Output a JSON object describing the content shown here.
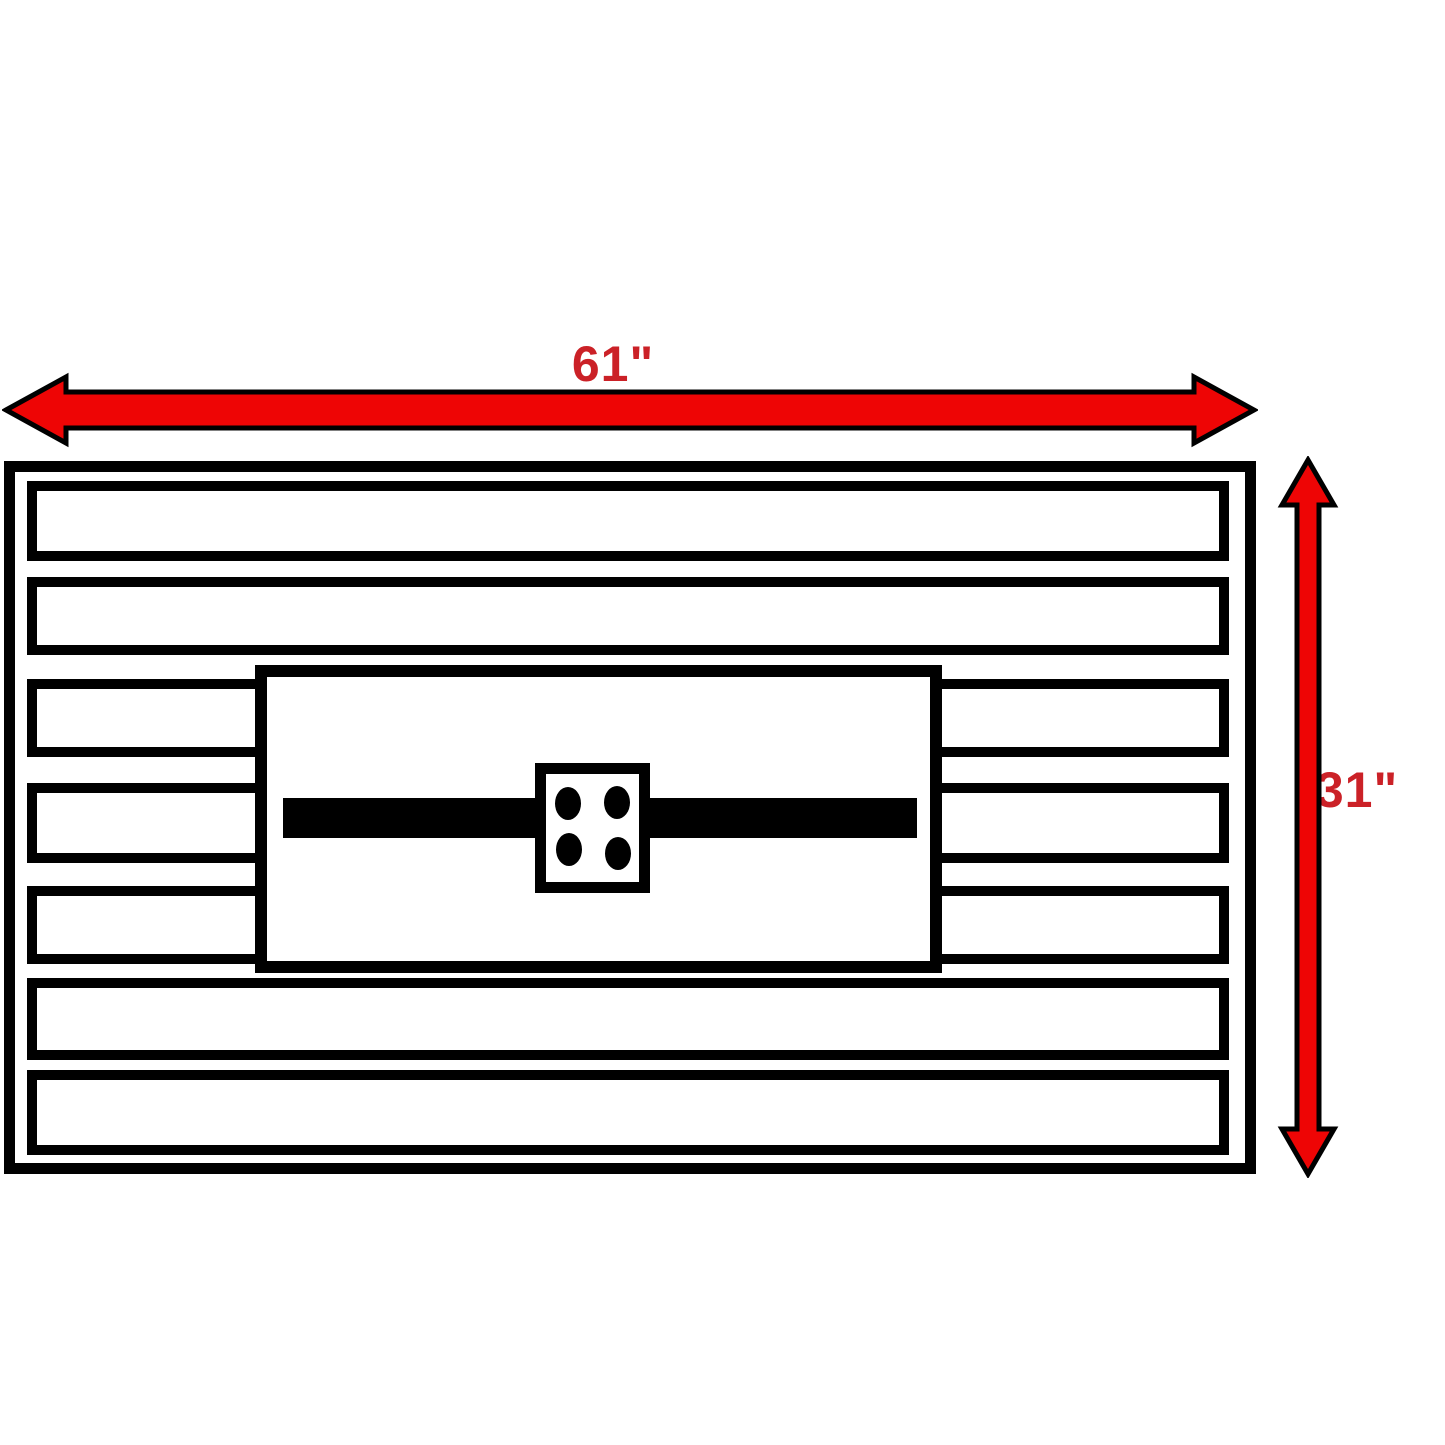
{
  "dimensions": {
    "width_label": "61\"",
    "height_label": "31\""
  },
  "diagram": {
    "type": "dimension-drawing",
    "view": "top-view",
    "slat_rows_total": 7,
    "full_width_slat_rows": 4,
    "split_slat_rows": 3,
    "bolt_hole_count": 4
  },
  "colors": {
    "arrow_fill": "#ee0505",
    "arrow_outline": "#000000",
    "label_red": "#cb2127",
    "line_black": "#000000",
    "background": "#ffffff"
  }
}
